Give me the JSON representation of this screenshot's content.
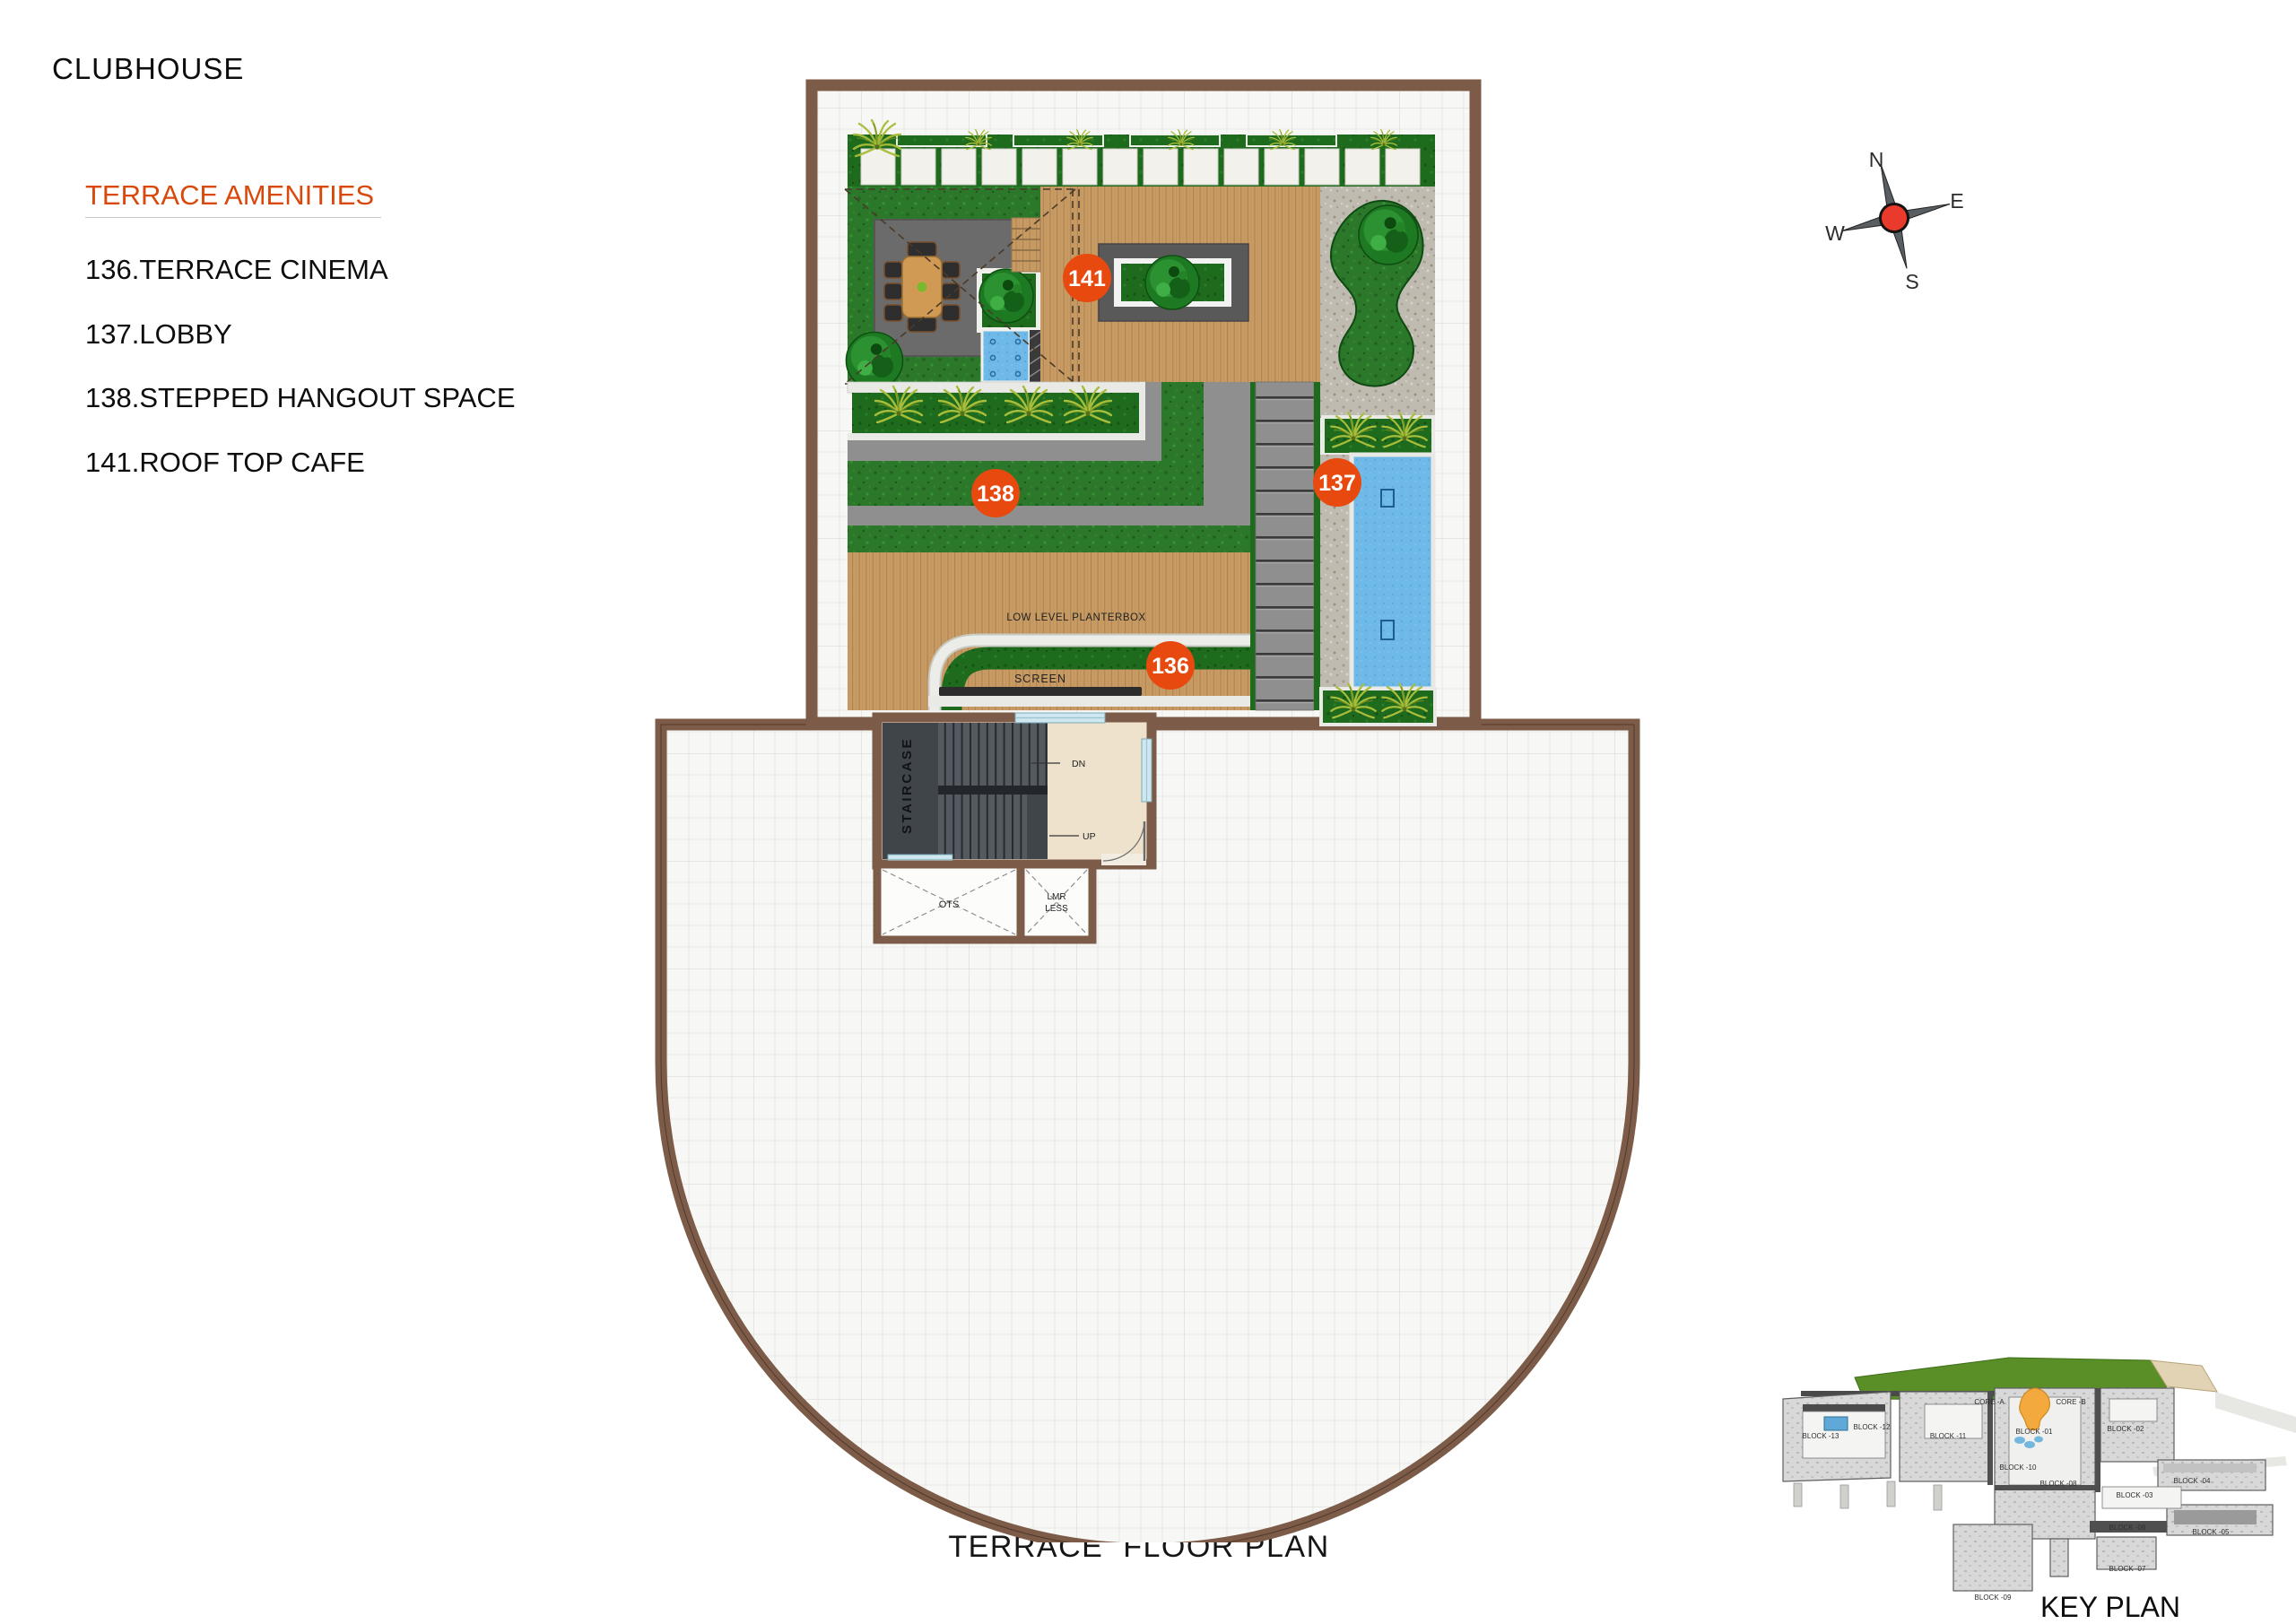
{
  "header": {
    "title": "CLUBHOUSE"
  },
  "legend": {
    "heading": "TERRACE AMENITIES",
    "items": [
      {
        "text": "136.TERRACE CINEMA"
      },
      {
        "text": "137.LOBBY"
      },
      {
        "text": "138.STEPPED HANGOUT SPACE"
      },
      {
        "text": "141.ROOF TOP CAFE"
      }
    ]
  },
  "plan": {
    "markers": [
      {
        "number": "136",
        "name": "TERRACE CINEMA"
      },
      {
        "number": "137",
        "name": "LOBBY"
      },
      {
        "number": "138",
        "name": "STEPPED HANGOUT SPACE"
      },
      {
        "number": "141",
        "name": "ROOF TOP CAFE"
      }
    ],
    "annotations": {
      "low_level_planterbox": "LOW LEVEL PLANTERBOX",
      "screen": "SCREEN",
      "staircase": "STAIRCASE",
      "down": "DN",
      "up": "UP",
      "ots": "OTS",
      "lmr_line1": "LMR",
      "lmr_line2": "LESS"
    }
  },
  "compass": {
    "north": "N",
    "east": "E",
    "south": "S",
    "west": "W"
  },
  "footer": {
    "plan_title": "TERRACE  FLOOR PLAN"
  },
  "key_plan": {
    "title": "KEY PLAN",
    "labels": [
      {
        "text": "CORE -A"
      },
      {
        "text": "CORE -B"
      },
      {
        "text": "BLOCK -01"
      },
      {
        "text": "BLOCK -02"
      },
      {
        "text": "BLOCK -03"
      },
      {
        "text": "BLOCK -04"
      },
      {
        "text": "BLOCK -05"
      },
      {
        "text": "BLOCK -06"
      },
      {
        "text": "BLOCK -07"
      },
      {
        "text": "BLOCK -08"
      },
      {
        "text": "BLOCK -09"
      },
      {
        "text": "BLOCK -10"
      },
      {
        "text": "BLOCK -11"
      },
      {
        "text": "BLOCK -12"
      },
      {
        "text": "BLOCK -13"
      }
    ]
  },
  "colors": {
    "accent_orange": "#E8490F",
    "heading_orange": "#D8490B",
    "wall_brown": "#7C5C48",
    "lawn_green": "#2C782A",
    "planter_green": "#1E6B1E",
    "deck_wood": "#C79B63",
    "pool_blue": "#6FB9E8",
    "gravel_gray": "#C0BBB1",
    "patio_gray": "#6B6B6B",
    "step_gray": "#8F8F8F",
    "staircase_dark": "#40454A",
    "keyplan_green": "#5A8F27",
    "keyplan_highlight": "#F3A93D",
    "compass_red": "#E93A2C"
  }
}
